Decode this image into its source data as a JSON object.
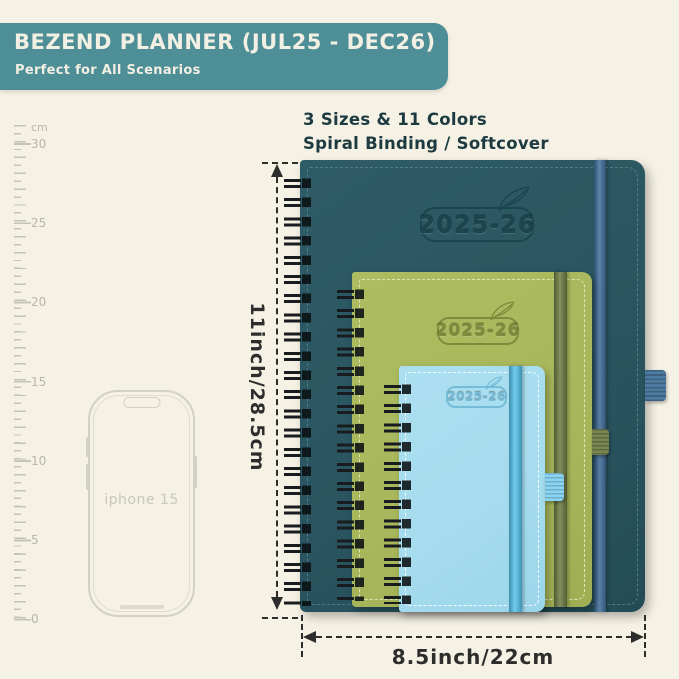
{
  "header": {
    "title": "BEZEND PLANNER (JUL25 - DEC26)",
    "subtitle": "Perfect for All Scenarios"
  },
  "intro": {
    "line1": "3 Sizes & 11 Colors",
    "line2": "Spiral Binding / Softcover"
  },
  "ruler": {
    "unit": "cm",
    "labels": [
      "30",
      "25",
      "20",
      "15",
      "10",
      "5",
      "0"
    ]
  },
  "phone": {
    "label": "iphone 15"
  },
  "planners": {
    "large": {
      "year": "2025-26",
      "cover_color": "#2a5560"
    },
    "medium": {
      "year": "2025-26",
      "cover_color": "#a9b75c"
    },
    "small": {
      "year": "2025-26",
      "cover_color": "#a6dcee"
    }
  },
  "dimensions": {
    "height_label": "11inch/28.5cm",
    "width_label": "8.5inch/22cm"
  },
  "colors": {
    "bg": "#f5f1e4",
    "banner": "#4e8e97",
    "banner_text": "#f2efe3",
    "ink": "#1d3a40",
    "dim": "#2d2d2d",
    "ruler": "#c5c2b7",
    "ruler_text": "#b8b5aa",
    "phone_line": "#d3d0c5",
    "phone_text": "#c9c6bb",
    "wire": "#191c1e",
    "cover_large": "#2a5560",
    "emboss_large": "#1c454f",
    "stitch_large": "#4e7d86",
    "band_large": "#42709d",
    "loop_large": "#4d7ba1",
    "cover_medium": "#a9b75c",
    "emboss_medium": "#7d8c3c",
    "stitch_medium": "#dde7b5",
    "band_medium": "#6f7d44",
    "loop_medium": "#7a8751",
    "cover_small": "#a6dcee",
    "emboss_small": "#74bcd7",
    "stitch_small": "#f2fbff",
    "band_small": "#57c4ec",
    "loop_small": "#8ad4f4"
  }
}
